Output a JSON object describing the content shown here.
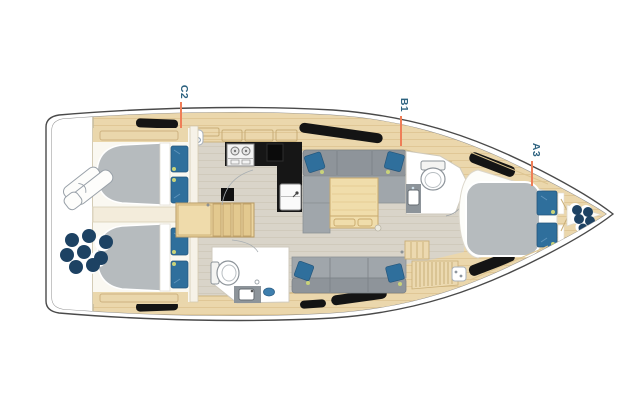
{
  "canvas": {
    "width": 638,
    "height": 401,
    "background": "#ffffff"
  },
  "plan": {
    "type": "sailing-yacht-interior-floor-plan",
    "view": "top-view",
    "bow_direction": "right",
    "cabin_labels": [
      {
        "text": "C2"
      },
      {
        "text": "B1"
      },
      {
        "text": "A3"
      }
    ],
    "label_style": {
      "text_color": "#2e6380",
      "leader_color": "#ef7e58"
    },
    "features": [
      "hull-outline",
      "transom-liferaft",
      "transom-fenders",
      "aft-cabin-port",
      "aft-cabin-starboard",
      "companionway-steps",
      "mast-post",
      "galley-counter",
      "stove",
      "galley-sink",
      "saloon-sofa-port",
      "saloon-sofa-starboard",
      "saloon-table",
      "aft-head-toilet",
      "aft-head-vanity",
      "forward-head-toilet",
      "forward-head-vanity",
      "nav-slat-seat",
      "forward-cabin-bed",
      "bow-anchor-chain",
      "deck-hatches"
    ],
    "palette": {
      "hull_line": "#4a4a4a",
      "inner_hull_line": "#8d8d8d",
      "deck_wood": "#ebd7ac",
      "floor": "#d9d4c9",
      "counter_black": "#161616",
      "upholstery_gray": "#8e949a",
      "mattress_gray": "#b6bbbe",
      "pillow_blue": "#2f6f9c",
      "fender_navy": "#1d4263",
      "accent_green": "#c9d37a",
      "trim_wood": "#c9ae77"
    }
  }
}
